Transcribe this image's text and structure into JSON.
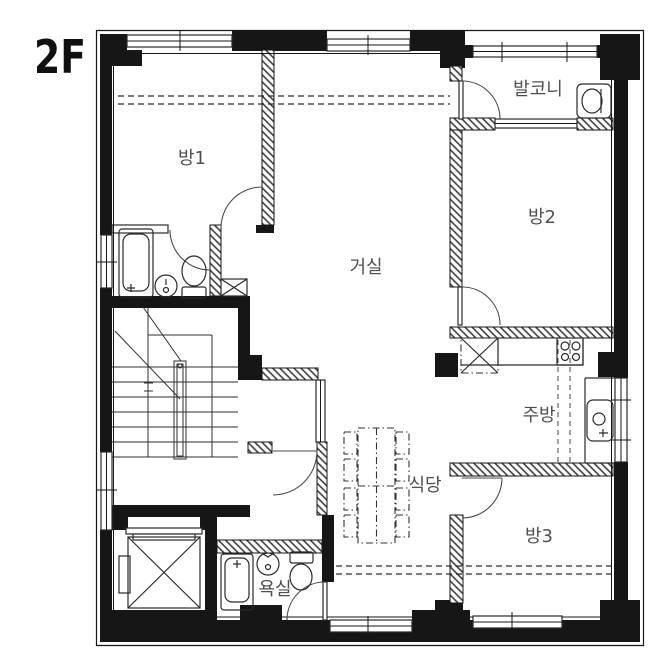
{
  "title": "2F",
  "rooms": [
    {
      "name": "room1",
      "label": "방1"
    },
    {
      "name": "balcony",
      "label": "발코니"
    },
    {
      "name": "room2",
      "label": "방2"
    },
    {
      "name": "living-room",
      "label": "거실"
    },
    {
      "name": "kitchen",
      "label": "주방"
    },
    {
      "name": "dining",
      "label": "식당"
    },
    {
      "name": "room3",
      "label": "방3"
    },
    {
      "name": "bathroom",
      "label": "욕실"
    }
  ],
  "fixtures": [
    "bathtub",
    "toilet",
    "washbasin",
    "washing-machine",
    "refrigerator",
    "stove",
    "kitchen-sink",
    "dining-table",
    "stairs",
    "elevator",
    "duct-shaft"
  ],
  "colors": {
    "wall": "#161616",
    "label": "#4f4f4f",
    "background": "#ffffff"
  }
}
